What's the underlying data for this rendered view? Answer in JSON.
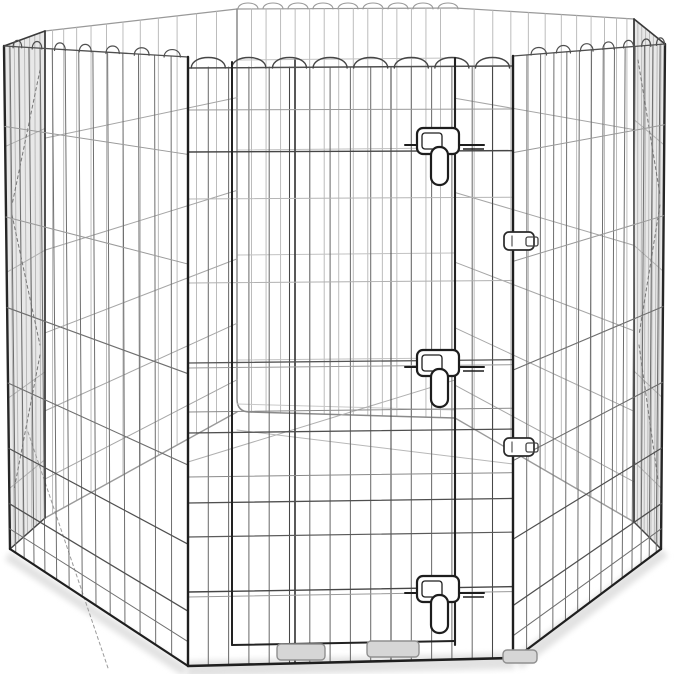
{
  "image": {
    "type": "product-photo",
    "alt": "Octagonal foldable metal wire pet exercise pen with scalloped panel tops and a front door panel secured by three vertical slide-bolt latches, photographed on a plain white background with a soft shadow underneath",
    "background": "#ffffff"
  },
  "product": {
    "name": "foldable-metal-pet-exercise-pen",
    "panel_count": 8,
    "door_count": 1,
    "latch_count": 3,
    "connector_clip_count": 2,
    "floor_tab_count": 3,
    "top_style": "scalloped-arches"
  },
  "drawing": {
    "colors": {
      "frameDark": "#1f1f1f",
      "doorFrame": "#222222",
      "wireMid": "#4f4f4f",
      "wireSoft": "#6e6e6e",
      "wireLight": "#9a9a9a",
      "backWire": "#b5b5b5",
      "backLine": "#a6a6a6",
      "backRim": "#999999",
      "backFrame": "#8a8a8a",
      "stripShade": "rgba(110,110,110,0.16)",
      "shadow": "#e2e2e2",
      "latch": "#1d1d1d",
      "tabFill": "#d6d6d6",
      "tabStroke": "#8f8f8f",
      "white": "#ffffff"
    },
    "latch_tops": [
      128,
      350,
      576
    ],
    "clip_tops": [
      232,
      438
    ],
    "floor_tabs": [
      [
        277,
        644,
        48,
        16
      ],
      [
        367,
        641,
        52,
        16
      ],
      [
        503,
        650,
        34,
        13
      ]
    ]
  }
}
